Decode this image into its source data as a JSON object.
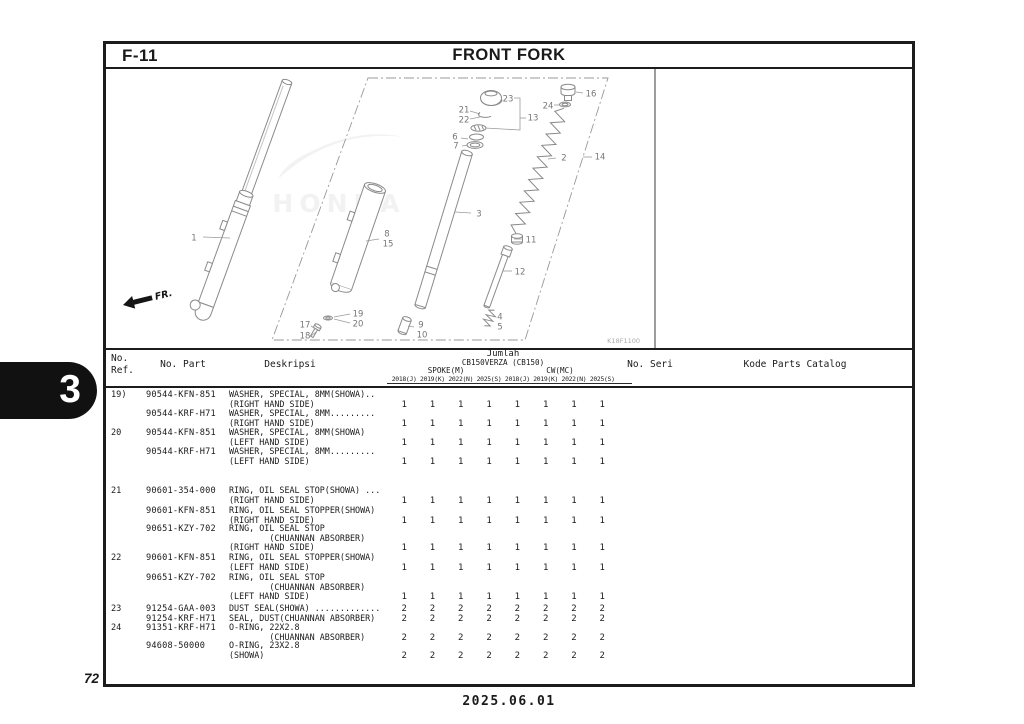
{
  "page": {
    "section_code": "F-11",
    "title": "FRONT FORK",
    "section_tab": "3",
    "page_number": "72",
    "date": "2025.06.01",
    "diagram_code": "K18F1100",
    "fr_label": "FR.",
    "watermark": "HONDA"
  },
  "diagram": {
    "callouts": [
      {
        "label": "1",
        "x": 91,
        "y": 171,
        "line": [
          100,
          170,
          127,
          171
        ]
      },
      {
        "label": "2",
        "x": 461,
        "y": 91,
        "line": [
          453,
          91,
          445,
          92
        ]
      },
      {
        "label": "3",
        "x": 376,
        "y": 147,
        "line": [
          368,
          146,
          352,
          145
        ]
      },
      {
        "label": "4",
        "x": 397,
        "y": 250
      },
      {
        "label": "5",
        "x": 397,
        "y": 260
      },
      {
        "label": "6",
        "x": 352,
        "y": 70,
        "line": [
          358,
          71,
          365,
          72
        ]
      },
      {
        "label": "7",
        "x": 353,
        "y": 79,
        "line": [
          359,
          79,
          365,
          78
        ]
      },
      {
        "label": "8",
        "x": 284,
        "y": 167
      },
      {
        "label": "15",
        "x": 285,
        "y": 177,
        "line": [
          276,
          172,
          263,
          174
        ]
      },
      {
        "label": "9",
        "x": 318,
        "y": 258
      },
      {
        "label": "10",
        "x": 319,
        "y": 268,
        "line": [
          311,
          260,
          305,
          259
        ]
      },
      {
        "label": "11",
        "x": 428,
        "y": 173,
        "line": [
          420,
          172,
          411,
          172
        ]
      },
      {
        "label": "12",
        "x": 417,
        "y": 205,
        "line": [
          409,
          204,
          400,
          204
        ]
      },
      {
        "label": "13",
        "x": 430,
        "y": 51
      },
      {
        "label": "14",
        "x": 497,
        "y": 90,
        "line": [
          489,
          90,
          480,
          90
        ]
      },
      {
        "label": "16",
        "x": 488,
        "y": 27,
        "line": [
          480,
          26,
          473,
          25
        ]
      },
      {
        "label": "17",
        "x": 202,
        "y": 258,
        "line": [
          208,
          259,
          213,
          262
        ]
      },
      {
        "label": "18",
        "x": 202,
        "y": 269,
        "line": [
          208,
          269,
          213,
          265
        ]
      },
      {
        "label": "19",
        "x": 255,
        "y": 247,
        "line": [
          247,
          247,
          231,
          250
        ]
      },
      {
        "label": "20",
        "x": 255,
        "y": 257,
        "line": [
          247,
          256,
          231,
          252
        ]
      },
      {
        "label": "21",
        "x": 361,
        "y": 43,
        "line": [
          367,
          44,
          377,
          47
        ]
      },
      {
        "label": "22",
        "x": 361,
        "y": 53,
        "line": [
          367,
          52,
          377,
          50
        ]
      },
      {
        "label": "23",
        "x": 405,
        "y": 32
      },
      {
        "label": "24",
        "x": 445,
        "y": 39,
        "line": [
          451,
          38,
          456,
          38
        ]
      }
    ]
  },
  "table": {
    "headers": {
      "ref_line1": "No.",
      "ref_line2": "Ref.",
      "part": "No. Part",
      "desc": "Deskripsi",
      "qty": "Jumlah",
      "model": "CB150VERZA (CB150)",
      "variant_left": "SPOKE(M)",
      "variant_right": "CW(MC)",
      "years": [
        "2018(J)",
        "2019(K)",
        "2022(N)",
        "2025(S)",
        "2018(J)",
        "2019(K)",
        "2022(N)",
        "2025(S)"
      ],
      "seri": "No. Seri",
      "kode": "Kode Parts Catalog"
    },
    "rows": [
      {
        "ref": "19)",
        "part": "90544-KFN-851",
        "lines": [
          "WASHER, SPECIAL, 8MM(SHOWA)..",
          "(RIGHT HAND SIDE)"
        ],
        "quantities": [
          1,
          1,
          1,
          1,
          1,
          1,
          1,
          1
        ]
      },
      {
        "ref": "",
        "part": "90544-KRF-H71",
        "lines": [
          "WASHER, SPECIAL, 8MM.........",
          "(RIGHT HAND SIDE)"
        ],
        "quantities": [
          1,
          1,
          1,
          1,
          1,
          1,
          1,
          1
        ]
      },
      {
        "ref": "20",
        "part": "90544-KFN-851",
        "lines": [
          "WASHER, SPECIAL, 8MM(SHOWA)",
          "(LEFT HAND SIDE)"
        ],
        "quantities": [
          1,
          1,
          1,
          1,
          1,
          1,
          1,
          1
        ]
      },
      {
        "ref": "",
        "part": "90544-KRF-H71",
        "lines": [
          "WASHER, SPECIAL, 8MM.........",
          "(LEFT HAND SIDE)"
        ],
        "quantities": [
          1,
          1,
          1,
          1,
          1,
          1,
          1,
          1
        ]
      },
      {
        "ref": "21",
        "part": "90601-354-000",
        "lines": [
          "RING, OIL SEAL STOP(SHOWA) ...",
          "(RIGHT HAND SIDE)"
        ],
        "quantities": [
          1,
          1,
          1,
          1,
          1,
          1,
          1,
          1
        ]
      },
      {
        "ref": "",
        "part": "90601-KFN-851",
        "lines": [
          "RING, OIL SEAL STOPPER(SHOWA)",
          "(RIGHT HAND SIDE)"
        ],
        "quantities": [
          1,
          1,
          1,
          1,
          1,
          1,
          1,
          1
        ]
      },
      {
        "ref": "",
        "part": "90651-KZY-702",
        "lines": [
          "RING, OIL SEAL STOP",
          "        (CHUANNAN ABSORBER)",
          "(RIGHT HAND SIDE)"
        ],
        "quantities": [
          1,
          1,
          1,
          1,
          1,
          1,
          1,
          1
        ]
      },
      {
        "ref": "22",
        "part": "90601-KFN-851",
        "lines": [
          "RING, OIL SEAL STOPPER(SHOWA)",
          "(LEFT HAND SIDE)"
        ],
        "quantities": [
          1,
          1,
          1,
          1,
          1,
          1,
          1,
          1
        ]
      },
      {
        "ref": "",
        "part": "90651-KZY-702",
        "lines": [
          "RING, OIL SEAL STOP",
          "        (CHUANNAN ABSORBER)",
          "(LEFT HAND SIDE)"
        ],
        "quantities": [
          1,
          1,
          1,
          1,
          1,
          1,
          1,
          1
        ]
      },
      {
        "ref": "23",
        "part": "91254-GAA-003",
        "lines": [
          "DUST SEAL(SHOWA) ............."
        ],
        "quantities": [
          2,
          2,
          2,
          2,
          2,
          2,
          2,
          2
        ]
      },
      {
        "ref": "",
        "part": "91254-KRF-H71",
        "lines": [
          "SEAL, DUST(CHUANNAN ABSORBER)"
        ],
        "quantities": [
          2,
          2,
          2,
          2,
          2,
          2,
          2,
          2
        ]
      },
      {
        "ref": "24",
        "part": "91351-KRF-H71",
        "lines": [
          "O-RING, 22X2.8",
          "        (CHUANNAN ABSORBER)"
        ],
        "quantities": [
          2,
          2,
          2,
          2,
          2,
          2,
          2,
          2
        ]
      },
      {
        "ref": "",
        "part": "94608-50000",
        "lines": [
          "O-RING, 23X2.8",
          "(SHOWA)"
        ],
        "quantities": [
          2,
          2,
          2,
          2,
          2,
          2,
          2,
          2
        ]
      }
    ]
  }
}
